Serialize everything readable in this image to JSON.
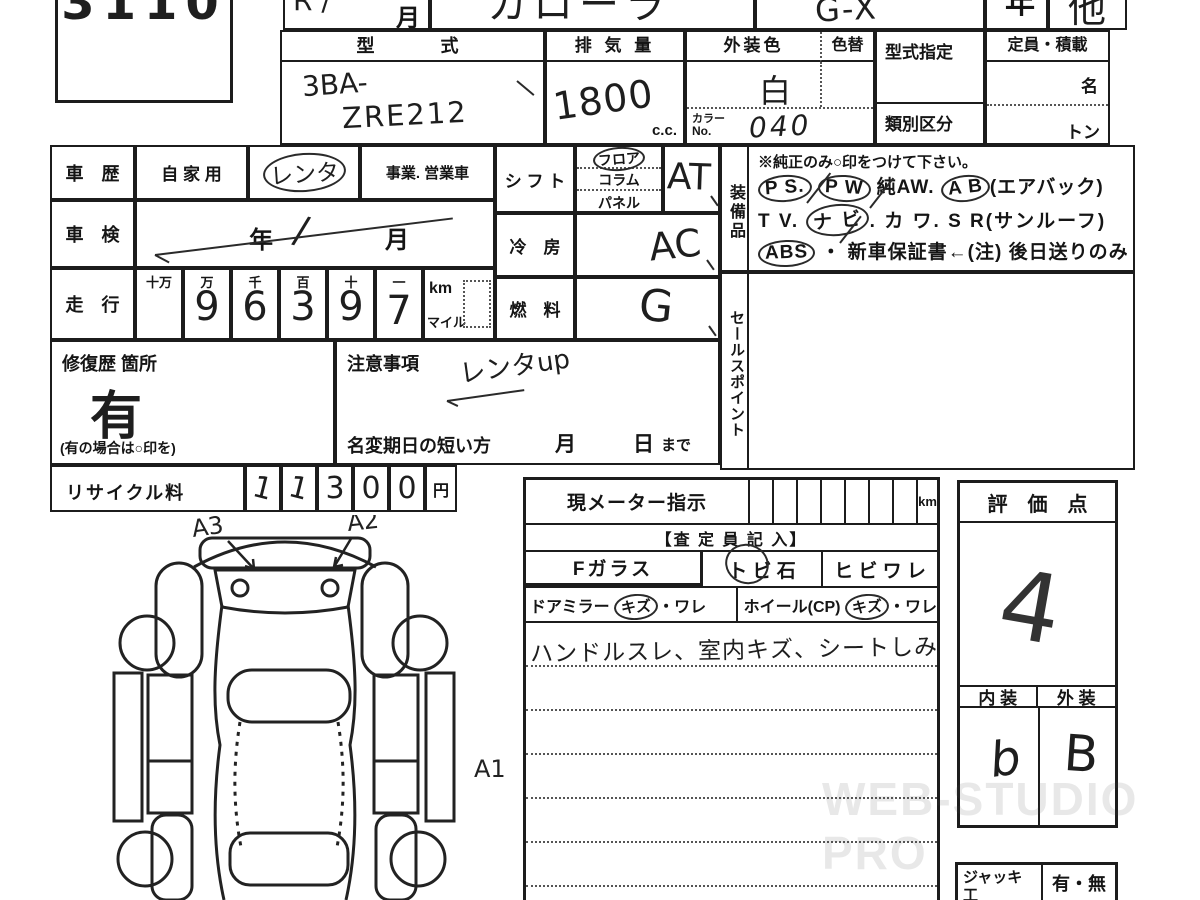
{
  "lot": {
    "number": "3110"
  },
  "top_row": {
    "reg_hand": "R /",
    "reg_label": "月",
    "model_hand": "カローラ",
    "grade_hand": "G-X",
    "year_label": "年",
    "other_hand": "他"
  },
  "spec": {
    "katashiki_label": "型　　式",
    "katashiki_line1": "3BA-",
    "katashiki_line2": "ZRE212",
    "haikiryo_label": "排 気 量",
    "haikiryo_value": "1800",
    "haikiryo_unit": "c.c.",
    "gaiso_label": "外装色",
    "iroka_label": "色替",
    "gaiso_value": "白",
    "color_no_label1": "カラー",
    "color_no_label2": "No.",
    "color_no_value": "040",
    "shitei_label": "型式指定",
    "ruibetsu_label": "類別区分",
    "teiin_label": "定員・積載",
    "teiin_unit1": "名",
    "teiin_unit2": "トン"
  },
  "left": {
    "shareki_label": "車　歴",
    "shareki_opt1": "自 家 用",
    "shareki_opt2": "レンタ",
    "shareki_opt3": "事業. 営業車",
    "shaken_label": "車　検",
    "shaken_year": "年",
    "shaken_slash": "/",
    "shaken_month": "月",
    "soko_label": "走　行",
    "soko_cols": [
      "十万",
      "万",
      "千",
      "百",
      "十",
      "一"
    ],
    "soko_digits": [
      "",
      "9",
      "6",
      "3",
      "9",
      "7"
    ],
    "soko_unit_km": "km",
    "soko_unit_mile": "マイル",
    "shufuku_label": "修復歴 箇所",
    "shufuku_value": "有",
    "shufuku_note": "(有の場合は○印を)",
    "chui_label": "注意事項",
    "chui_hand": "レンタup",
    "meihen_label": "名変期日の短い方",
    "meihen_month": "月",
    "meihen_day": "日",
    "meihen_made": "まで",
    "recycle_label": "リサイクル料",
    "recycle_digits": [
      "1",
      "1",
      "3",
      "0",
      "0"
    ],
    "recycle_unit": "円"
  },
  "mid": {
    "shift_label": "シ フ ト",
    "shift_opts": [
      "フロア",
      "コラム",
      "パネル"
    ],
    "shift_value": "AT",
    "ac_label": "冷　房",
    "ac_value": "AC",
    "fuel_label": "燃　料",
    "fuel_value": "G"
  },
  "equip": {
    "side_label": "装備品",
    "note": "※純正のみ○印をつけて下さい。",
    "l1": [
      {
        "t": "P S."
      },
      {
        "t": "P W"
      },
      {
        "t": "純AW."
      },
      {
        "t": "A B"
      },
      {
        "t": "(エアバック)"
      }
    ],
    "l2": [
      {
        "t": "T V."
      },
      {
        "t": "ナ ビ"
      },
      {
        "t": ". カ ワ."
      },
      {
        "t": "S R(サンルーフ)"
      }
    ],
    "l3": [
      {
        "t": "ABS"
      },
      {
        "t": "・ 新車保証書←(注) 後日送りのみ"
      }
    ]
  },
  "sales": {
    "side_label": "セールスポイント"
  },
  "meter": {
    "label": "現メーター指示",
    "unit": "km",
    "satei_label": "【査 定 員 記 入】",
    "fglass_label": "Fガラス",
    "tobiishi_label": "ト ビ 石",
    "hibiware_label": "ヒ ビ ワ レ",
    "mirror_label": "ドアミラー",
    "mirror_kizu": "キズ",
    "mirror_ware": "・ワレ",
    "wheel_label": "ホイール(CP)",
    "wheel_kizu": "キズ",
    "wheel_ware": "・ワレ",
    "hand_note": "ハンドルスレ、室内キズ、シートしみ"
  },
  "hyoka": {
    "label": "評　価　点",
    "score": "4",
    "naiso_label": "内 装",
    "gaiso_label": "外 装",
    "naiso_value": "b",
    "gaiso_value": "B"
  },
  "jack": {
    "label1": "ジャッキ",
    "label2": "工　具",
    "value": "有・無"
  },
  "diagram": {
    "a1": "A1",
    "a2": "A2",
    "a3": "A3"
  },
  "watermark": "WEB-STUDIO PRO"
}
